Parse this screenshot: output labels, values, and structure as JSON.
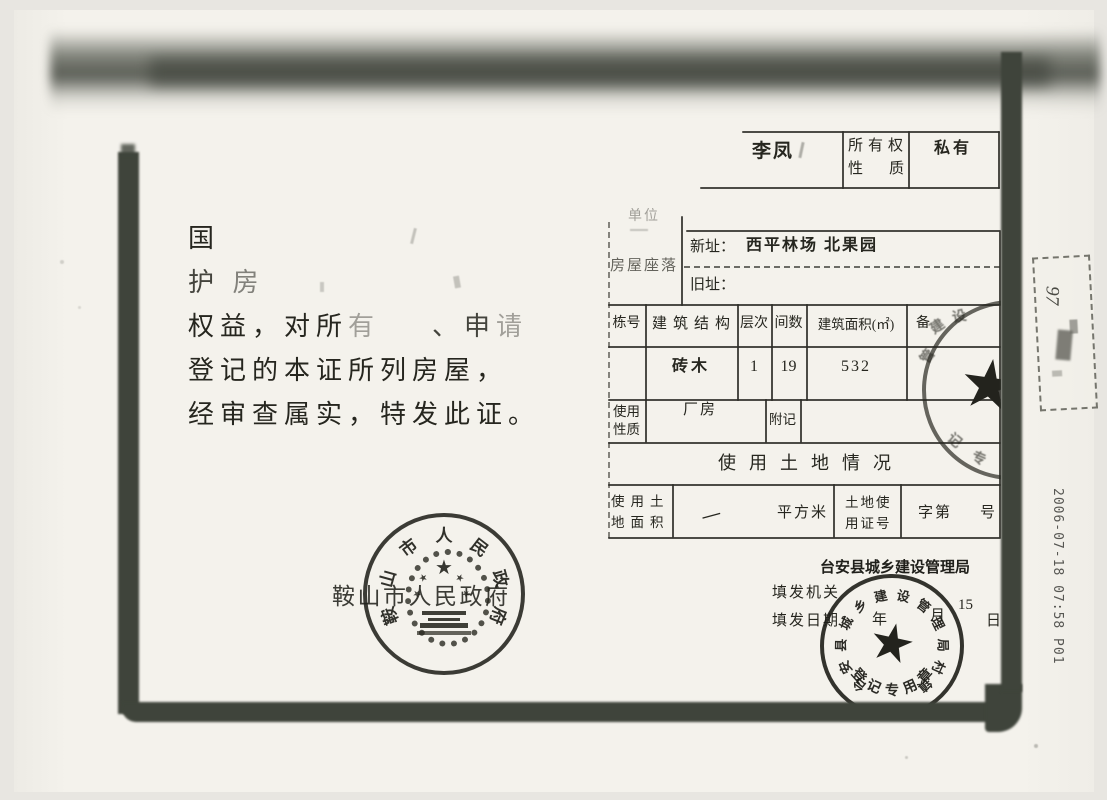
{
  "fax": {
    "timestamp": "2006-07-18 07:58 P01",
    "margin_number": "97"
  },
  "preamble": {
    "l1": "国",
    "l2a": "护",
    "l2b": "房",
    "l3a": "权益，对所",
    "l3b": "有",
    "l3c": "、申",
    "l3d": "请",
    "l4": "登记的本证所列房屋，",
    "l5": "经审查属实，特发此证。"
  },
  "owner_row": {
    "name": "李凤",
    "label1": "所有权",
    "label2": "性质",
    "value": "私有"
  },
  "location": {
    "unit": "单位",
    "label": "房屋座落",
    "new_label": "新址：",
    "new_value": "西平林场 北果园",
    "old_label": "旧址："
  },
  "building": {
    "h_no": "栋号",
    "h_struct": "建筑结构",
    "h_floors": "层次",
    "h_rooms": "间数",
    "h_area": "建筑面积(㎡)",
    "h_note": "备",
    "v_struct": "砖木",
    "v_floors": "1",
    "v_rooms": "19",
    "v_area": "532"
  },
  "usage": {
    "label1": "使用",
    "label2": "性质",
    "value": "厂房",
    "note": "附记"
  },
  "land": {
    "banner": "使用土地情况",
    "al1": "使用土",
    "al2": "地面积",
    "area_value": "—",
    "unit": "平方米",
    "cl1": "土地使",
    "cl2": "用证号",
    "cp": "字第",
    "cs": "号"
  },
  "issuance": {
    "bureau": "台安县城乡建设管理局",
    "org_label": "填发机关",
    "date_label": "填发日期",
    "year": "年",
    "month": "月",
    "day_num": "15",
    "day": "日"
  },
  "stamps": {
    "left_ring": "鞍山市人民政府",
    "left_printed": "鞍山市人民政府",
    "br_ring": "台安县城乡建设管理局村镇",
    "br_bottom": "登记专用章",
    "edge_fragments": "建设管记专"
  }
}
